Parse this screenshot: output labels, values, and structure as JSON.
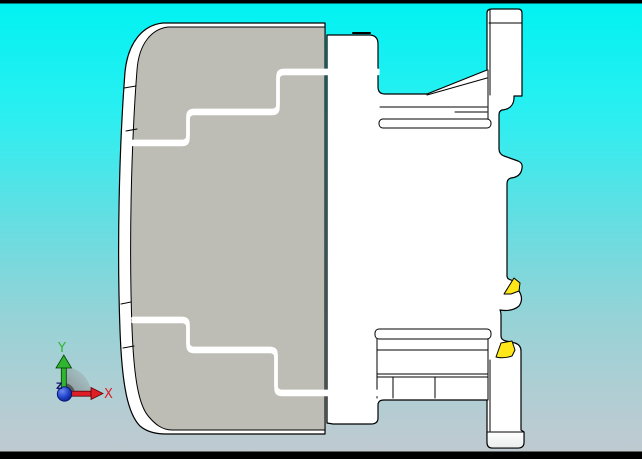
{
  "viewer": {
    "type": "cad-3d-viewport",
    "model": "contactor-side-view",
    "view_orientation": "right-side"
  },
  "letterbox": {
    "top_height": 3.5,
    "bottom_height": 7.5
  },
  "axes": {
    "x": {
      "label": "X"
    },
    "y": {
      "label": "Y"
    },
    "z": {
      "label": "Z"
    }
  },
  "markers": {
    "din_rail_wedges": 2
  },
  "colors": {
    "bg_top": "#00F2F2",
    "bg_upper": "#2BEFF1",
    "bg_mid": "#64DEE2",
    "bg_lower": "#93D3D7",
    "bg_low2": "#ACCFD4",
    "bg_bottom": "#C2C9D0",
    "body_gray": "#BDBDB5",
    "part_white": "#FFFFFF",
    "part_shade": "#E9EDEC",
    "outline": "#000000",
    "marker_yellow": "#FFE619",
    "axis_x": "#DE1F26",
    "axis_y": "#2FB52F",
    "axis_z": "#15156B",
    "origin_blue": "#2143C8",
    "origin_blue_dark": "#001270",
    "sector_gray": "#8A8A8A",
    "bar_black": "#000000"
  }
}
